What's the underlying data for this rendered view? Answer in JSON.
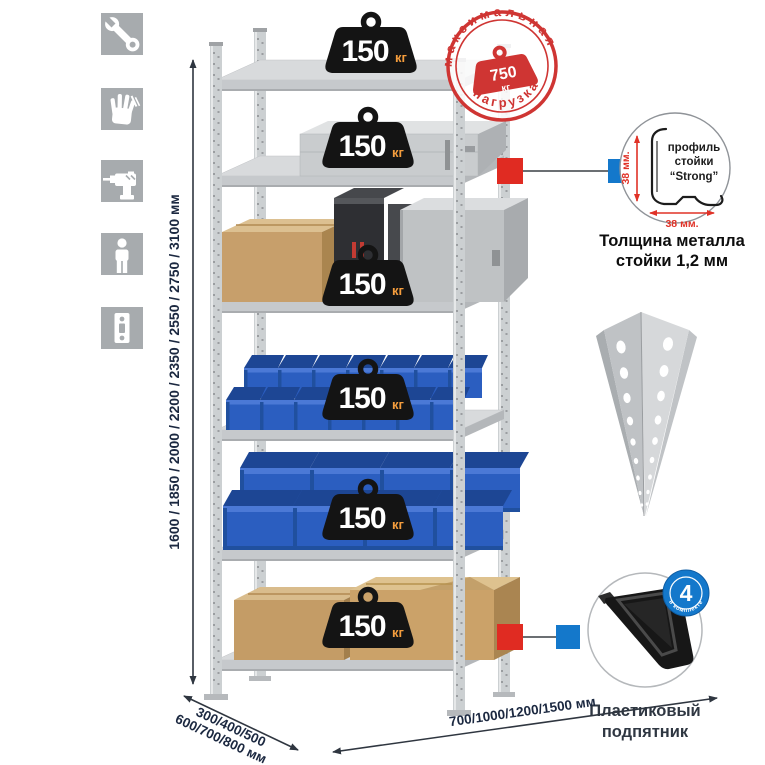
{
  "icons_column": {
    "items": [
      {
        "name": "wrench"
      },
      {
        "name": "gloves"
      },
      {
        "name": "drill"
      },
      {
        "name": "person"
      },
      {
        "name": "post-profile"
      }
    ]
  },
  "dimensions": {
    "height_label": "1600 / 1850 / 2000 / 2200 / 2350 / 2550 / 2750 / 3100 мм",
    "depth_label_line1": "300/400/500",
    "depth_label_line2": "600/700/800 мм",
    "width_label": "700/1000/1200/1500 мм"
  },
  "shelf_load_badge": {
    "value": "150",
    "unit": "кг",
    "count": 6
  },
  "max_load_stamp": {
    "arc_top": "максимальная",
    "arc_bottom": "нагрузка",
    "value": "750",
    "unit": "кг"
  },
  "profile_callout": {
    "drawing_label_line1": "профиль",
    "drawing_label_line2": "стойки",
    "drawing_label_line3": "“Strong”",
    "dim_vertical": "38 мм.",
    "dim_horizontal": "38 мм.",
    "caption_line1": "Толщина металла",
    "caption_line2": "стойки 1,2 мм"
  },
  "foot_callout": {
    "badge_number": "4",
    "badge_arc_text": "в комплекте",
    "caption_line1": "Пластиковый",
    "caption_line2": "подпятник"
  },
  "colors": {
    "stamp_red": "#cf3533",
    "dim_red": "#e03227",
    "connector_red": "#e02b22",
    "connector_blue": "#1478cb",
    "bin_blue": "#2b5ec0",
    "kg_orange": "#f49d3d",
    "weight_black": "#141414",
    "text_dark": "#1b2840",
    "metal_gray": "#d2d5d7",
    "icon_gray": "#a7abae"
  }
}
